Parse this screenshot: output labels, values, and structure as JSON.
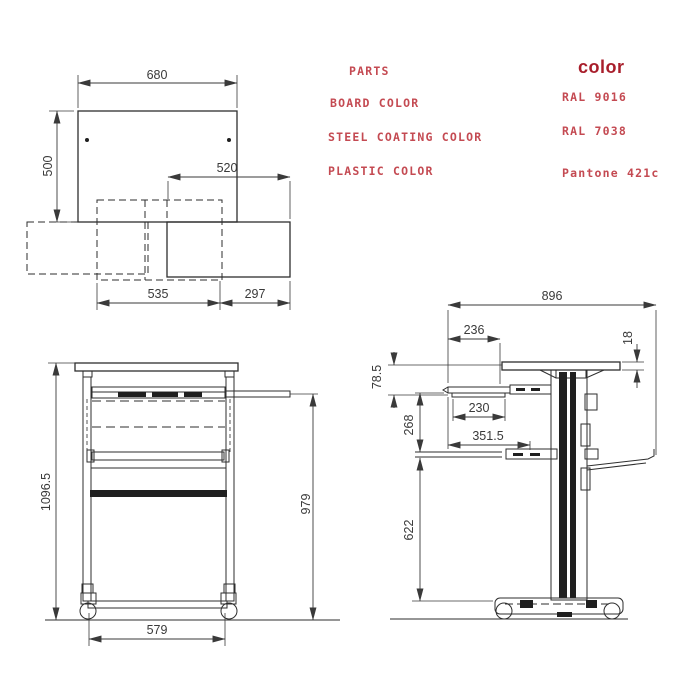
{
  "palette": {
    "line_color": "#2e2e2e",
    "dim_text_color": "#3a3a3a",
    "table_text_color": "#c44a52",
    "table_header_color": "#a81e2b",
    "background": "#ffffff"
  },
  "parts_table": {
    "parts_header": "PARTS",
    "color_header": "color",
    "rows": [
      {
        "part": "BOARD COLOR",
        "value": "RAL 9016"
      },
      {
        "part": "STEEL COATING COLOR",
        "value": "RAL 7038"
      },
      {
        "part": "PLASTIC COLOR",
        "value": "Pantone 421c"
      }
    ]
  },
  "top_view": {
    "board_width": "680",
    "board_depth": "500",
    "tray_width": "520",
    "shelf_width": "535",
    "side_extension": "297"
  },
  "front_view": {
    "overall_height": "1096.5",
    "tray_height": "979",
    "base_width": "579"
  },
  "side_view": {
    "overall_depth": "896",
    "tray_extension": "236",
    "board_thickness": "18",
    "board_to_tray_drop": "78.5",
    "tray_depth": "230",
    "tray_to_shelf": "268",
    "shelf_depth": "351.5",
    "shelf_to_base": "622"
  }
}
